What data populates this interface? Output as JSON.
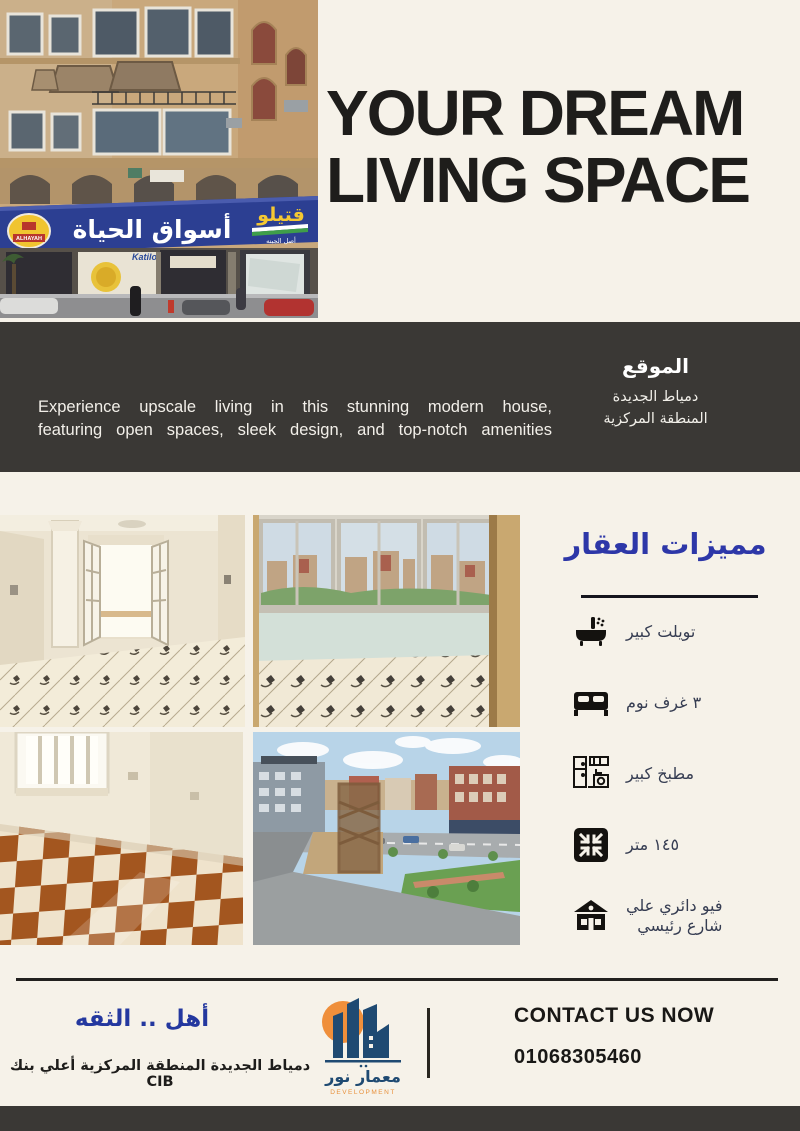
{
  "hero": {
    "title_line1": "YOUR DREAM",
    "title_line2": "LIVING SPACE"
  },
  "about": {
    "description_line1": "Experience upscale living in this stunning modern house,",
    "description_line2": "featuring open spaces, sleek design, and top-notch amenities",
    "location": {
      "title": "الموقع",
      "line1": "دمياط الجديدة",
      "line2": "المنطقة المركزية"
    }
  },
  "building_photo": {
    "main_sign": "أسواق الحياة",
    "side_sign": "قتيلو",
    "side_sign_sub": "أصل الجبنه",
    "badge": "ALHAYAH",
    "banner": "Katilo"
  },
  "features": {
    "title": "مميزات العقار",
    "items": [
      {
        "icon": "bathtub-icon",
        "label": "تويلت كبير"
      },
      {
        "icon": "bed-icon",
        "label": "٣ غرف نوم"
      },
      {
        "icon": "kitchen-icon",
        "label": "مطبخ كبير"
      },
      {
        "icon": "area-icon",
        "label": "١٤٥ متر"
      },
      {
        "icon": "house-icon",
        "label": "فيو دائري علي",
        "label_line2": "شارع رئيسي"
      }
    ]
  },
  "footer": {
    "slogan": "أهل .. الثقه",
    "address": "دمياط الجديدة المنطقة المركزية أعلي بنك CIB",
    "logo_name": "معمار نور",
    "logo_sub": "DEVELOPMENT",
    "contact_heading": "CONTACT US NOW",
    "phone": "01068305460"
  },
  "colors": {
    "cream": "#f6f2e9",
    "charcoal": "#3a3835",
    "accent_blue": "#2d37a8",
    "slogan_blue": "#24389f",
    "sign_blue": "#2c3f92",
    "logo_orange": "#ef8f3b",
    "logo_navy": "#1f4a72"
  }
}
